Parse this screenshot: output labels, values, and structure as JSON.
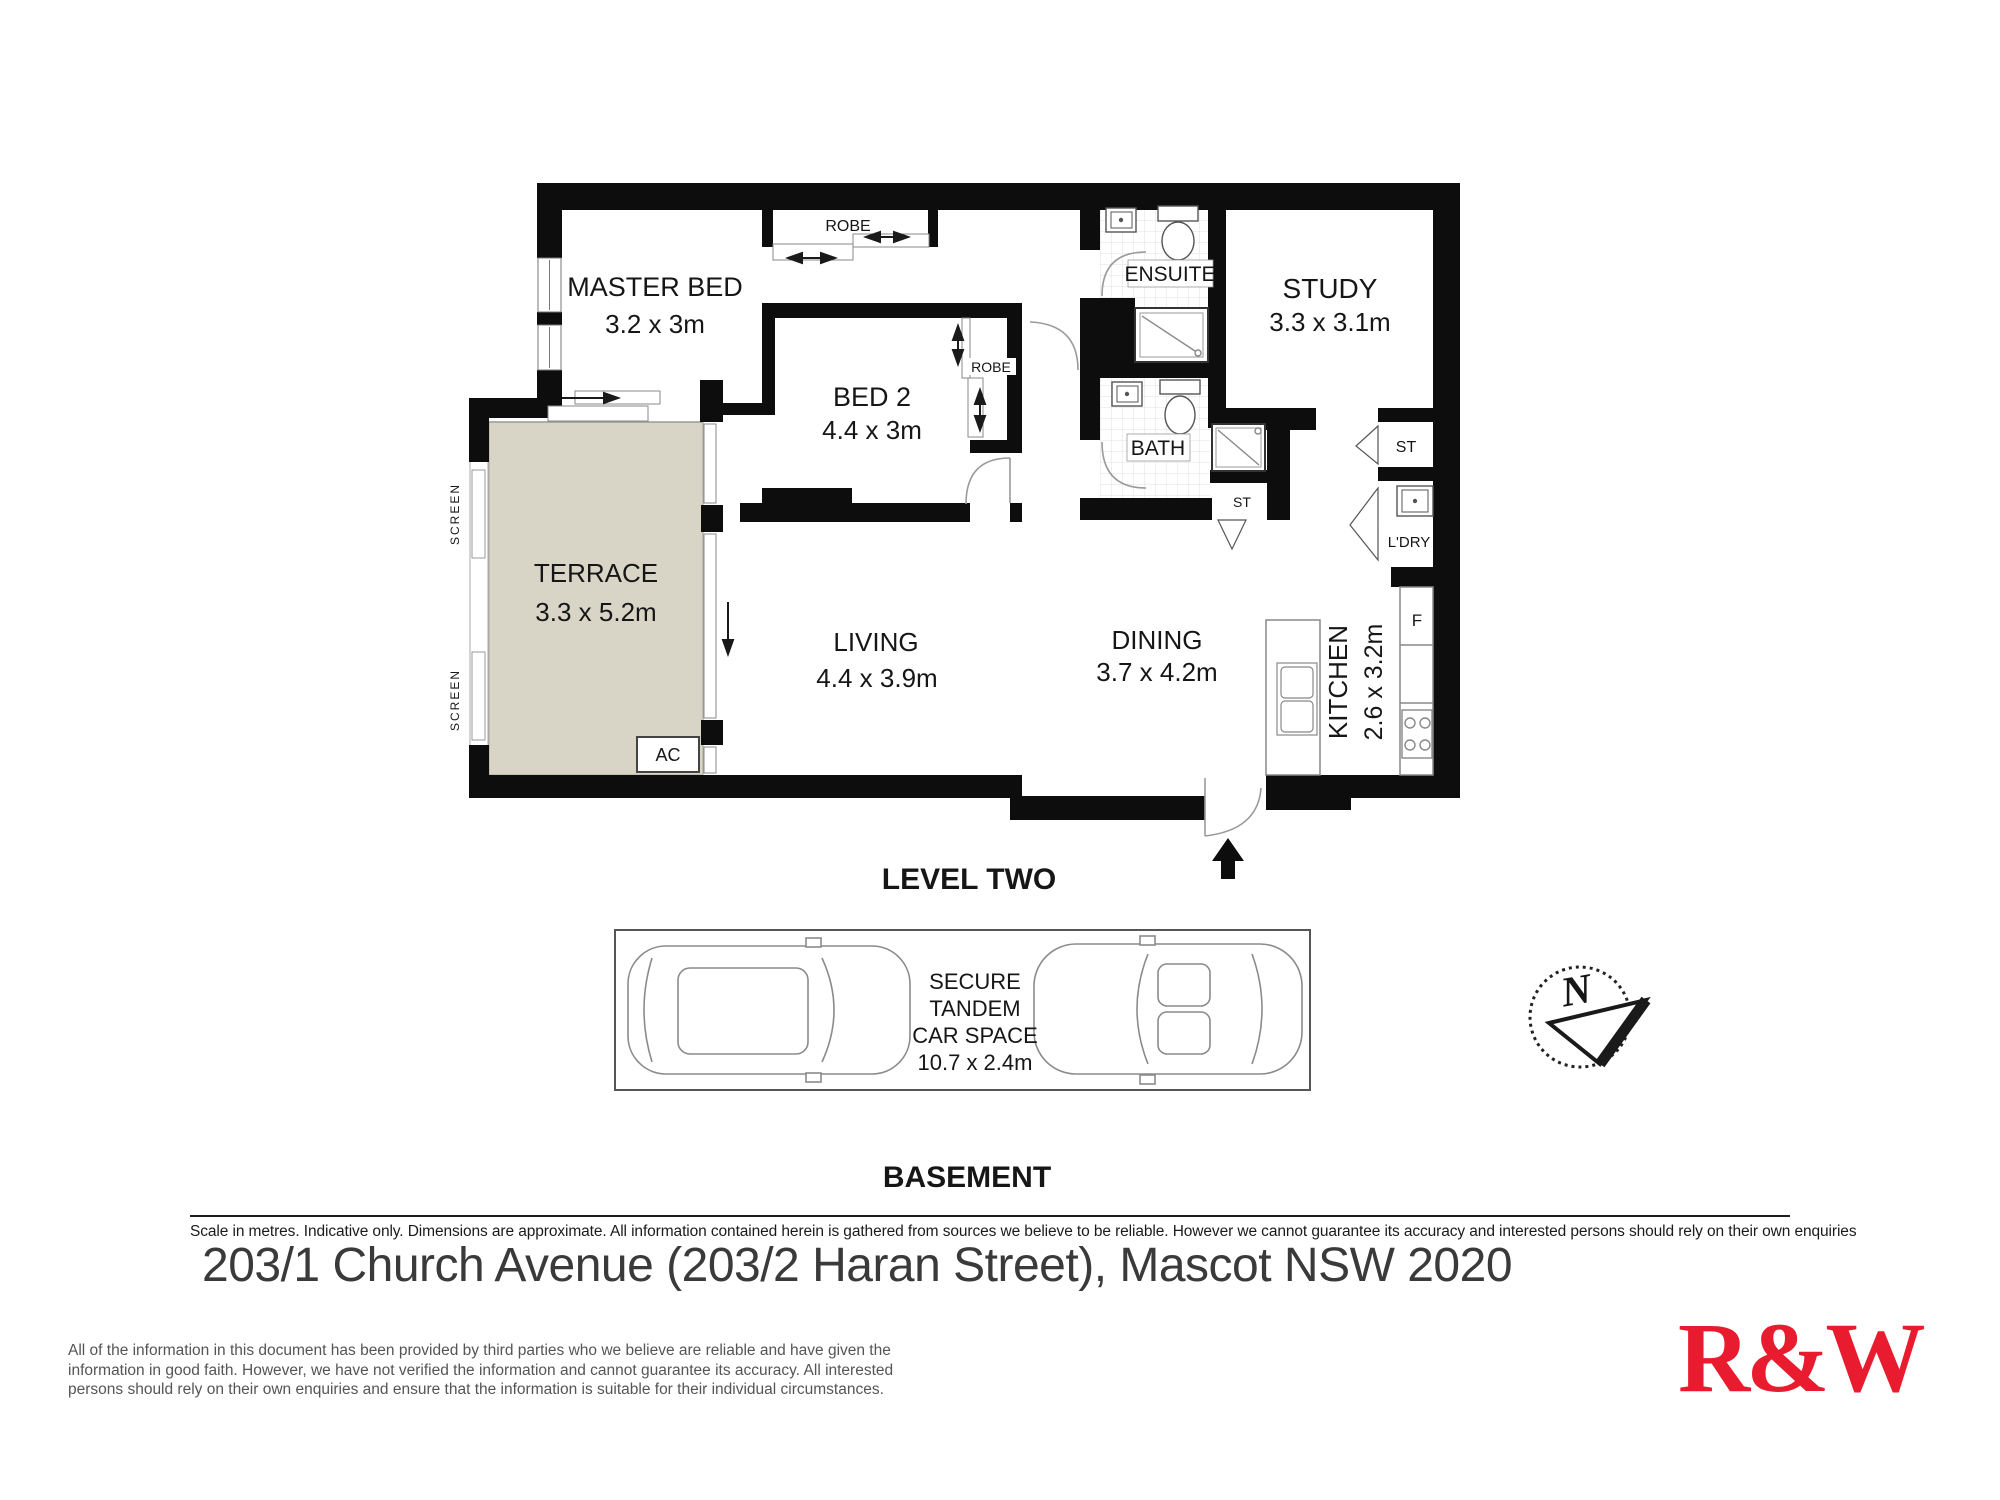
{
  "fp": {
    "level": "LEVEL TWO",
    "rooms": {
      "master": {
        "name": "MASTER BED",
        "dims": "3.2 x 3m"
      },
      "bed2": {
        "name": "BED 2",
        "dims": "4.4 x 3m"
      },
      "study": {
        "name": "STUDY",
        "dims": "3.3 x 3.1m"
      },
      "terrace": {
        "name": "TERRACE",
        "dims": "3.3 x 5.2m"
      },
      "living": {
        "name": "LIVING",
        "dims": "4.4 x 3.9m"
      },
      "dining": {
        "name": "DINING",
        "dims": "3.7 x 4.2m"
      },
      "kitchen": {
        "name": "KITCHEN",
        "dims": "2.6 x 3.2m"
      },
      "ensuite": {
        "name": "ENSUITE"
      },
      "bath": {
        "name": "BATH"
      },
      "laundry": {
        "name": "L'DRY"
      }
    },
    "labels": {
      "robe_master": "ROBE",
      "robe_bed2": "ROBE",
      "screen_upper": "SCREEN",
      "screen_lower": "SCREEN",
      "ac": "AC",
      "st_hall": "ST",
      "st_closet": "ST",
      "fridge": "F"
    }
  },
  "basement": {
    "heading": "BASEMENT",
    "lines": [
      "SECURE",
      "TANDEM",
      "CAR SPACE",
      "10.7 x 2.4m"
    ]
  },
  "compass": {
    "north": "N"
  },
  "footer": {
    "scale_note": "Scale in metres. Indicative only. Dimensions are approximate. All information contained herein is gathered from sources we believe to be reliable. However we cannot guarantee its accuracy and interested persons should rely on their own enquiries",
    "address": "203/1 Church Avenue (203/2 Haran Street), Mascot NSW 2020",
    "disclaimer": [
      "All of the information in this document has been provided by third parties who we believe are reliable and have given the",
      "information in good faith. However, we have not verified the information and cannot guarantee its accuracy. All interested",
      "persons should rely on their own enquiries and ensure that the information is suitable for their individual circumstances."
    ],
    "brand": "R&W"
  },
  "colors": {
    "wall": "#0d0d0d",
    "terrace_fill": "#d9d5c6",
    "brand_red": "#e81c2e"
  }
}
